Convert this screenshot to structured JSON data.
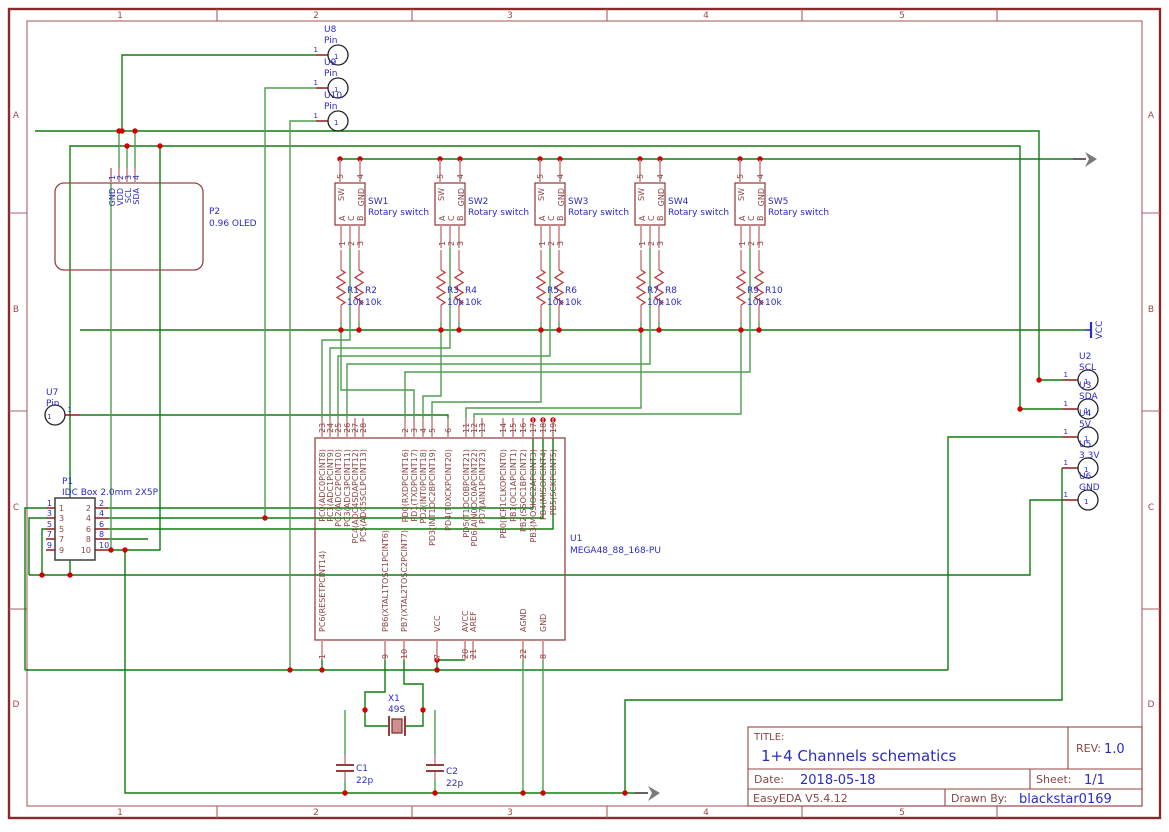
{
  "frame": {
    "top": [
      "1",
      "2",
      "3",
      "4",
      "5"
    ],
    "bottom": [
      "1",
      "2",
      "3",
      "4",
      "5"
    ],
    "left": [
      "A",
      "B",
      "C",
      "D"
    ],
    "right": [
      "A",
      "B",
      "C",
      "D"
    ]
  },
  "pin1": "1",
  "u8": {
    "ref": "U8",
    "val": "Pin"
  },
  "u9": {
    "ref": "U9",
    "val": "Pin"
  },
  "u10": {
    "ref": "U10",
    "val": "Pin"
  },
  "u7": {
    "ref": "U7",
    "val": "Pin"
  },
  "oled": {
    "ref": "P2",
    "val": "0.96 OLED",
    "nums": [
      "1",
      "2",
      "3",
      "4"
    ],
    "names": [
      "GND",
      "VDD",
      "SCL",
      "SDA"
    ]
  },
  "sw": {
    "refs": [
      "SW1",
      "SW2",
      "SW3",
      "SW4",
      "SW5"
    ],
    "val": "Rotary switch",
    "top_nums": [
      "5",
      "4"
    ],
    "top_names": [
      "SW",
      "GND"
    ],
    "bot_nums": [
      "1",
      "2",
      "3"
    ],
    "bot_names": [
      "A",
      "C",
      "B"
    ]
  },
  "res": {
    "refs": [
      "R1",
      "R2",
      "R3",
      "R4",
      "R5",
      "R6",
      "R7",
      "R8",
      "R9",
      "R10"
    ],
    "val": "10k"
  },
  "mcu": {
    "ref": "U1",
    "val": "MEGA48_88_168-PU",
    "top": [
      {
        "n": "23",
        "l": "PC0(ADC0PCINT8)"
      },
      {
        "n": "24",
        "l": "PC1(ADC1PCINT9)"
      },
      {
        "n": "25",
        "l": "PC2(ADC2PCINT10)"
      },
      {
        "n": "26",
        "l": "PC3(ADC3PCINT11)"
      },
      {
        "n": "27",
        "l": "PC4(ADC4SDAPCINT12)"
      },
      {
        "n": "28",
        "l": "PC5(ADC5SCLPCINT13)"
      },
      {
        "n": "2",
        "l": "PD0(RXDPCINT16)"
      },
      {
        "n": "3",
        "l": "PD1(TXDPCINT17)"
      },
      {
        "n": "4",
        "l": "PD2(INT0PCINT18)"
      },
      {
        "n": "5",
        "l": "PD3(INT1OC2BPCINT19)"
      },
      {
        "n": "6",
        "l": "PD4(T0XCKPCINT20)"
      },
      {
        "n": "11",
        "l": "PD5(T1OC0BPCINT21)"
      },
      {
        "n": "12",
        "l": "PD6(AIN0OC0APCINT22)"
      },
      {
        "n": "13",
        "l": "PD7(AIN1PCINT23)"
      },
      {
        "n": "14",
        "l": "PB0(ICP1CLKOPCINT0)"
      },
      {
        "n": "15",
        "l": "PB1(OC1APCINT1)"
      },
      {
        "n": "16",
        "l": "PB2(SSOC1BPCINT2)"
      },
      {
        "n": "17",
        "l": "PB3(MOSIOC2APCINT3)"
      },
      {
        "n": "18",
        "l": "PB4(MISOPCINT4)"
      },
      {
        "n": "19",
        "l": "PB5(SCKPCINT5)"
      }
    ],
    "bottom": [
      {
        "n": "1",
        "l": "PC6(RESETPCINT14)"
      },
      {
        "n": "9",
        "l": "PB6(XTAL1TOSC1PCINT6)"
      },
      {
        "n": "10",
        "l": "PB7(XTAL2TOSC2PCINT7)"
      },
      {
        "n": "7",
        "l": "VCC"
      },
      {
        "n": "20",
        "l": "AVCC"
      },
      {
        "n": "21",
        "l": "AREF"
      },
      {
        "n": "22",
        "l": "AGND"
      },
      {
        "n": "8",
        "l": "GND"
      }
    ]
  },
  "idc": {
    "ref": "P1",
    "val": "IDC Box 2.0mm 2X5P",
    "left": [
      "1",
      "3",
      "5",
      "7",
      "9"
    ],
    "right": [
      "2",
      "4",
      "6",
      "8",
      "10"
    ]
  },
  "right_pins": [
    {
      "ref": "U2",
      "val": "SCL"
    },
    {
      "ref": "U3",
      "val": "SDA"
    },
    {
      "ref": "U4",
      "val": "5V"
    },
    {
      "ref": "U5",
      "val": "3.3V"
    },
    {
      "ref": "U6",
      "val": "GND"
    }
  ],
  "xtal": {
    "ref": "X1",
    "val": "49S"
  },
  "caps": [
    {
      "ref": "C1",
      "val": "22p"
    },
    {
      "ref": "C2",
      "val": "22p"
    }
  ],
  "vcc_flag": "VCC",
  "title_block": {
    "title_label": "TITLE:",
    "title": "1+4 Channels schematics",
    "rev_label": "REV:",
    "rev": "1.0",
    "date_label": "Date:",
    "date": "2018-05-18",
    "sheet_label": "Sheet:",
    "sheet": "1/1",
    "tool": "EasyEDA V5.4.12",
    "drawn_label": "Drawn By:",
    "drawn": "blackstar0169"
  },
  "colors": {
    "wire": "#0E7D0E",
    "junction": "#D40000",
    "outline": "#964444",
    "blue": "#2B2BC8",
    "frame": "#9C4A4A"
  }
}
